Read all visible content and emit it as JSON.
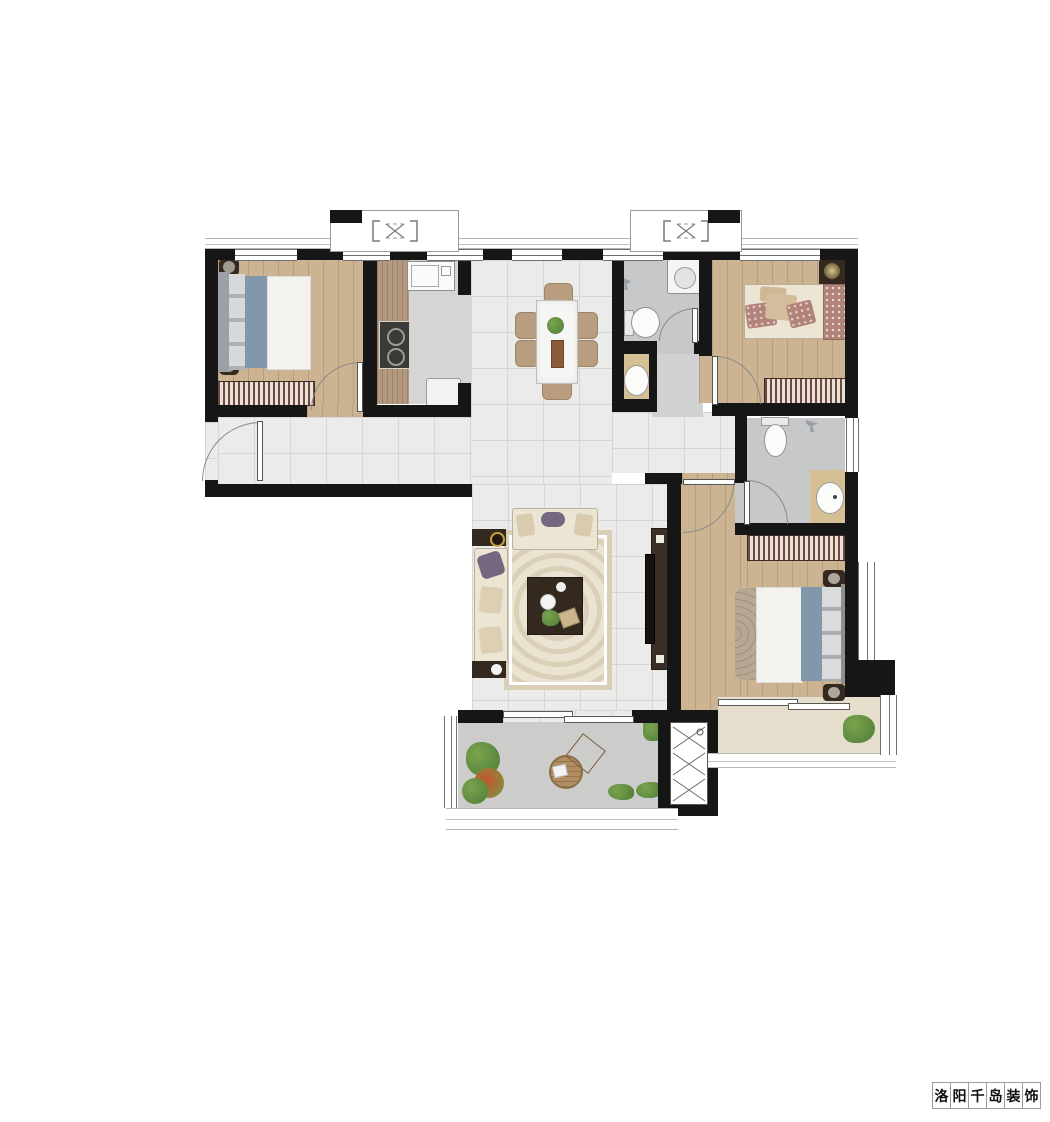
{
  "watermark": {
    "text": "洛阳千岛装饰",
    "chars": [
      "洛",
      "阳",
      "千",
      "岛",
      "装",
      "饰"
    ]
  },
  "icons": {
    "flue-marker": "bracketed-x-flue-symbol",
    "shaft-hatch": "stacked-x-duct-hatch",
    "door-swing": "quarter-circle-arc"
  },
  "colors": {
    "wall": "#161616",
    "tile": "#ebecea",
    "tileLine": "#d6d6d4",
    "wood": "#ccb493",
    "counterWood": "#b2997f",
    "kitchenFloor": "#d5d6d4",
    "bathFloor": "#c6c8ca",
    "lobbyFloor": "#cfd1d3",
    "vanityFloor": "#d5c096",
    "balconyFloor": "#cccdcb",
    "bayFloor": "#e6decc",
    "bedBlue": "#8297ab",
    "duvet": "#f3f2ef",
    "sofaCream": "#ece5d3",
    "pillowPurple": "#73687f",
    "rose": "#b1837b",
    "stripe": "#6d4a41",
    "stripeLight": "#e9e1d5",
    "rug": "#eae3d1",
    "rugBorder": "#d8cfb6",
    "darkWood": "#33291f",
    "marble": "#f5f5f3",
    "chairTan": "#b89e7f",
    "plant": "#4e7d3a",
    "plantLight": "#7aa34c",
    "glow": "#d9c489"
  }
}
